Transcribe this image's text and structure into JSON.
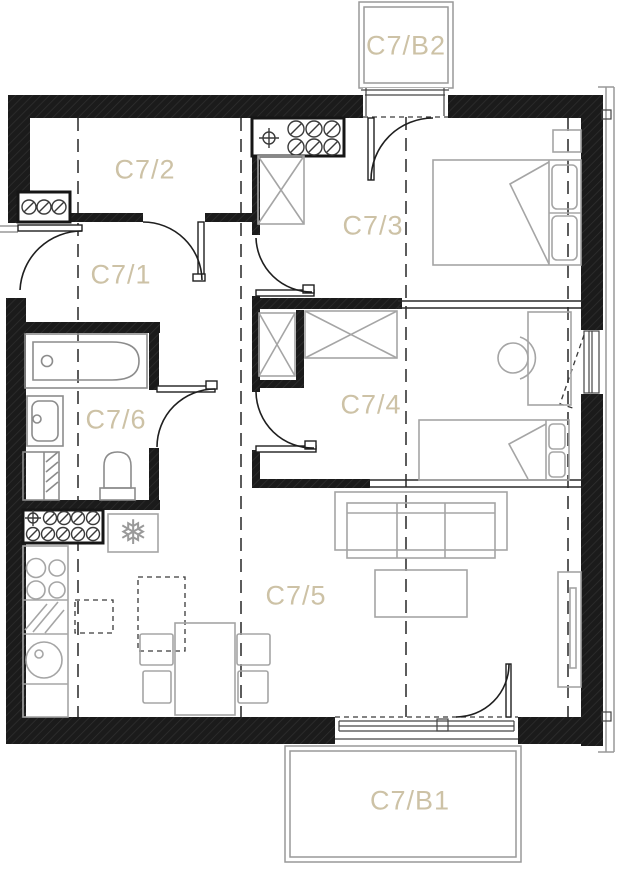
{
  "floorplan": {
    "unit": "C7",
    "rooms": [
      {
        "id": "c7-1",
        "label": "C7/1",
        "type": "hallway"
      },
      {
        "id": "c7-2",
        "label": "C7/2",
        "type": "room"
      },
      {
        "id": "c7-3",
        "label": "C7/3",
        "type": "bedroom"
      },
      {
        "id": "c7-4",
        "label": "C7/4",
        "type": "bedroom"
      },
      {
        "id": "c7-5",
        "label": "C7/5",
        "type": "living-room-kitchen"
      },
      {
        "id": "c7-6",
        "label": "C7/6",
        "type": "bathroom"
      }
    ],
    "balconies": [
      {
        "id": "c7-b1",
        "label": "C7/B1"
      },
      {
        "id": "c7-b2",
        "label": "C7/B2"
      }
    ],
    "symbols": {
      "snowflake": "❅"
    },
    "fixtures": [
      "bathtub",
      "washbasin",
      "washing-machine",
      "toilet",
      "refrigerator",
      "cooktop",
      "kitchen-sink",
      "dining-table",
      "dining-chairs",
      "sofa",
      "coffee-table",
      "tv-stand",
      "double-bed",
      "single-bed",
      "desk",
      "desk-chair",
      "wardrobes",
      "installation-shafts"
    ],
    "colors": {
      "label": "#cdc2a6",
      "wall": "#1b1b1b",
      "furniture": "#a5a5a5",
      "background": "#ffffff"
    }
  }
}
